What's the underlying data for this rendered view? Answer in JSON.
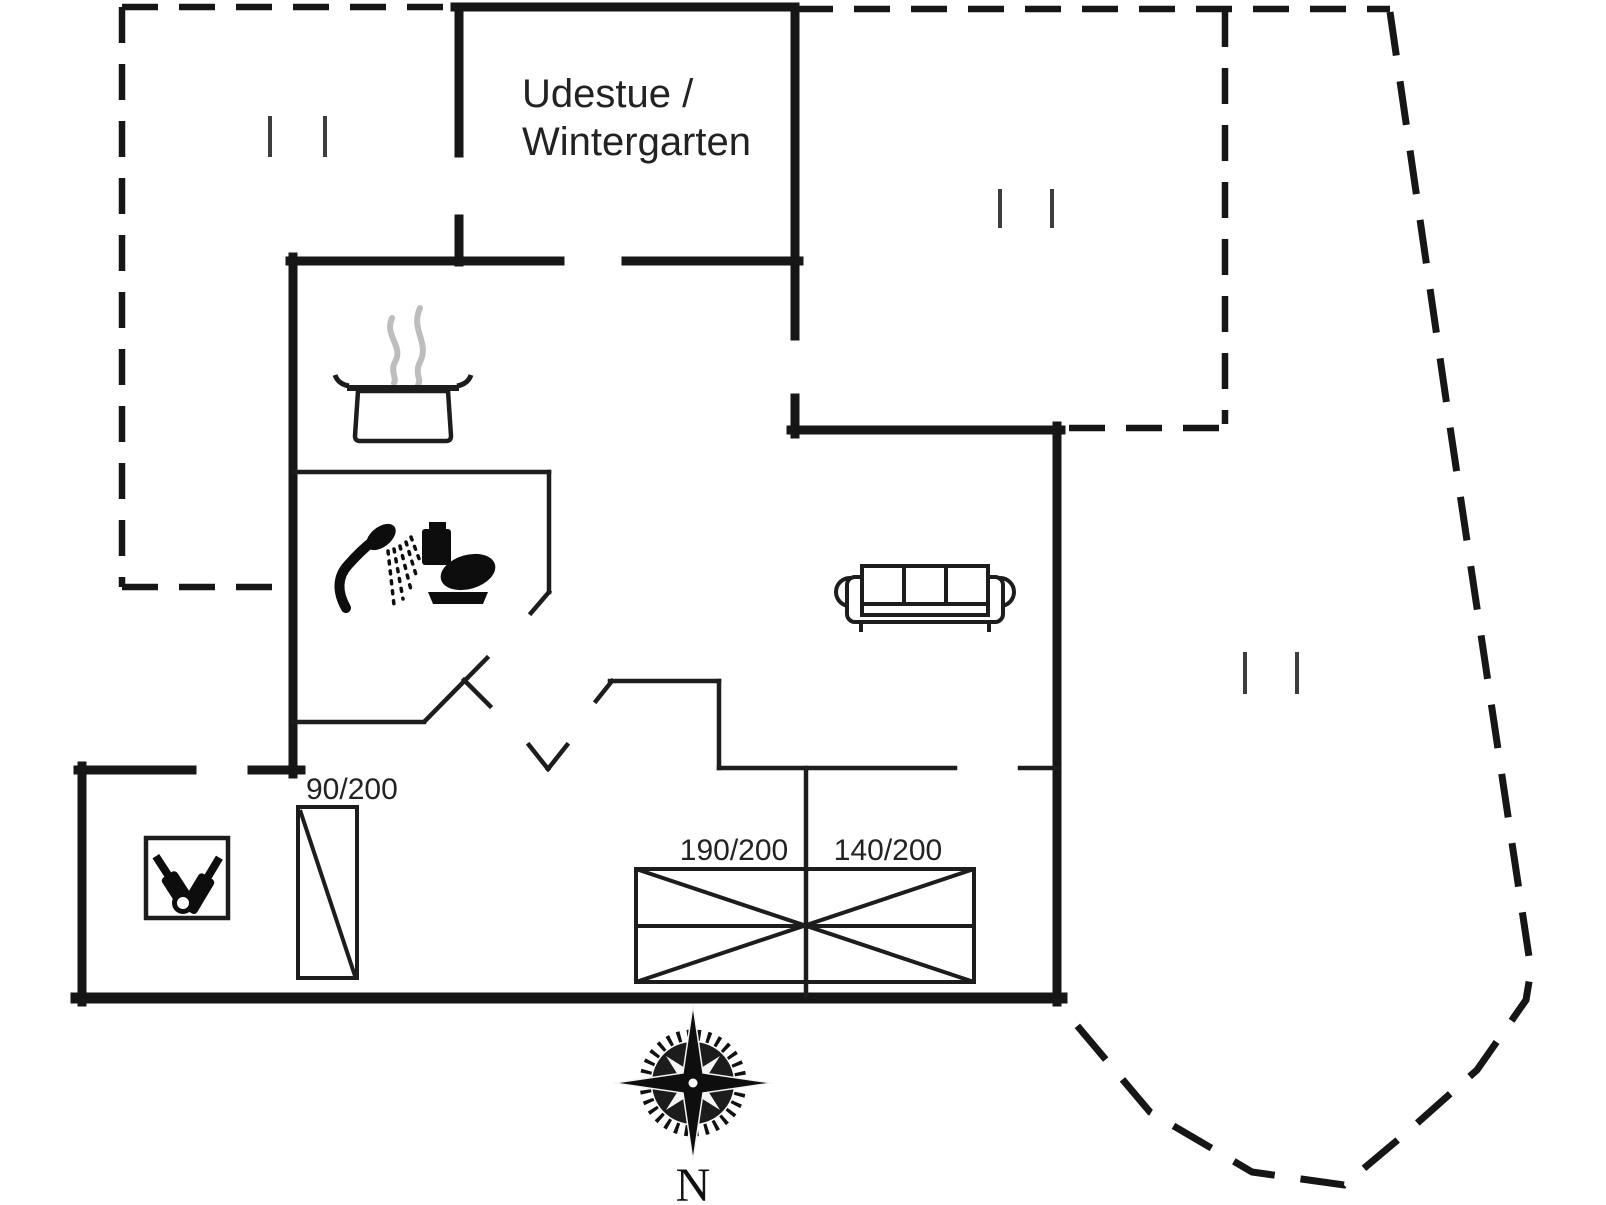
{
  "document": {
    "type": "holiday-home floor plan",
    "background_color": "#ffffff",
    "wall_color": "#161616",
    "steam_color": "#bdbdbd",
    "window_tick_color": "#3d3d3d"
  },
  "labels": {
    "sunroom_line1": "Udestue /",
    "sunroom_line2": "Wintergarten",
    "wardrobe_dim": "90/200",
    "bed_large_dim": "190/200",
    "bed_small_dim": "140/200",
    "compass_north": "N"
  },
  "icons": {
    "cooking_pot": "pot-with-steam-icon",
    "shower": "shower-spray-icon",
    "toilet": "toilet-icon",
    "sofa": "three-seat-sofa-icon",
    "beds": "crossed-double-bed-icon",
    "wardrobe": "wardrobe-diagonal-icon",
    "bottle_rack": "bottle-crate-icon",
    "compass": "compass-rose-icon",
    "window_marks": "window-tick-pair-icon"
  }
}
